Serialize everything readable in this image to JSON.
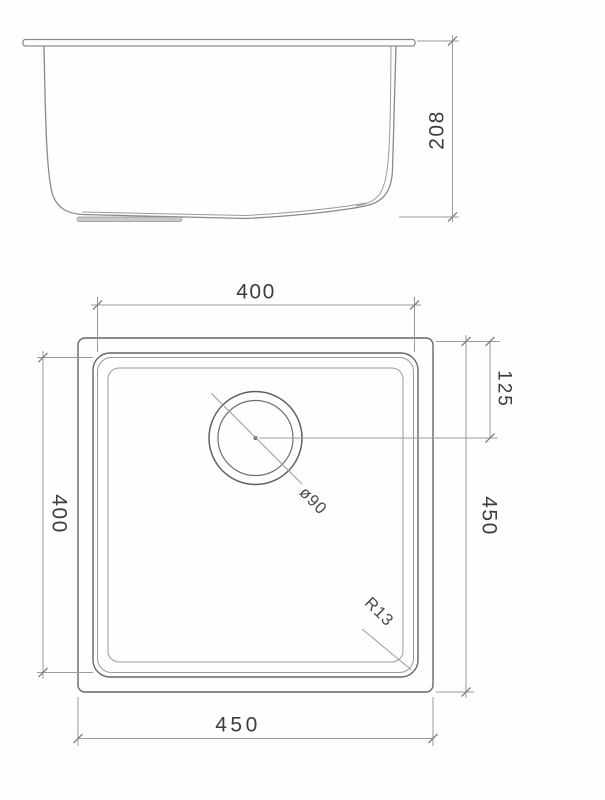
{
  "drawing": {
    "subject": "sink-technical-drawing",
    "colors": {
      "background": "#fefefe",
      "line": "#8a8a8a",
      "text": "#3d3d3d"
    },
    "views": {
      "side_elevation": {
        "dimensions": {
          "height": "208"
        }
      },
      "plan": {
        "dimensions": {
          "bowl_width_top": "400",
          "bowl_depth_left": "400",
          "overall_depth_right": "450",
          "overall_width_bottom": "450",
          "drain_center_to_edge": "125",
          "drain_diameter": "ø90",
          "corner_radius": "R13"
        }
      }
    }
  }
}
